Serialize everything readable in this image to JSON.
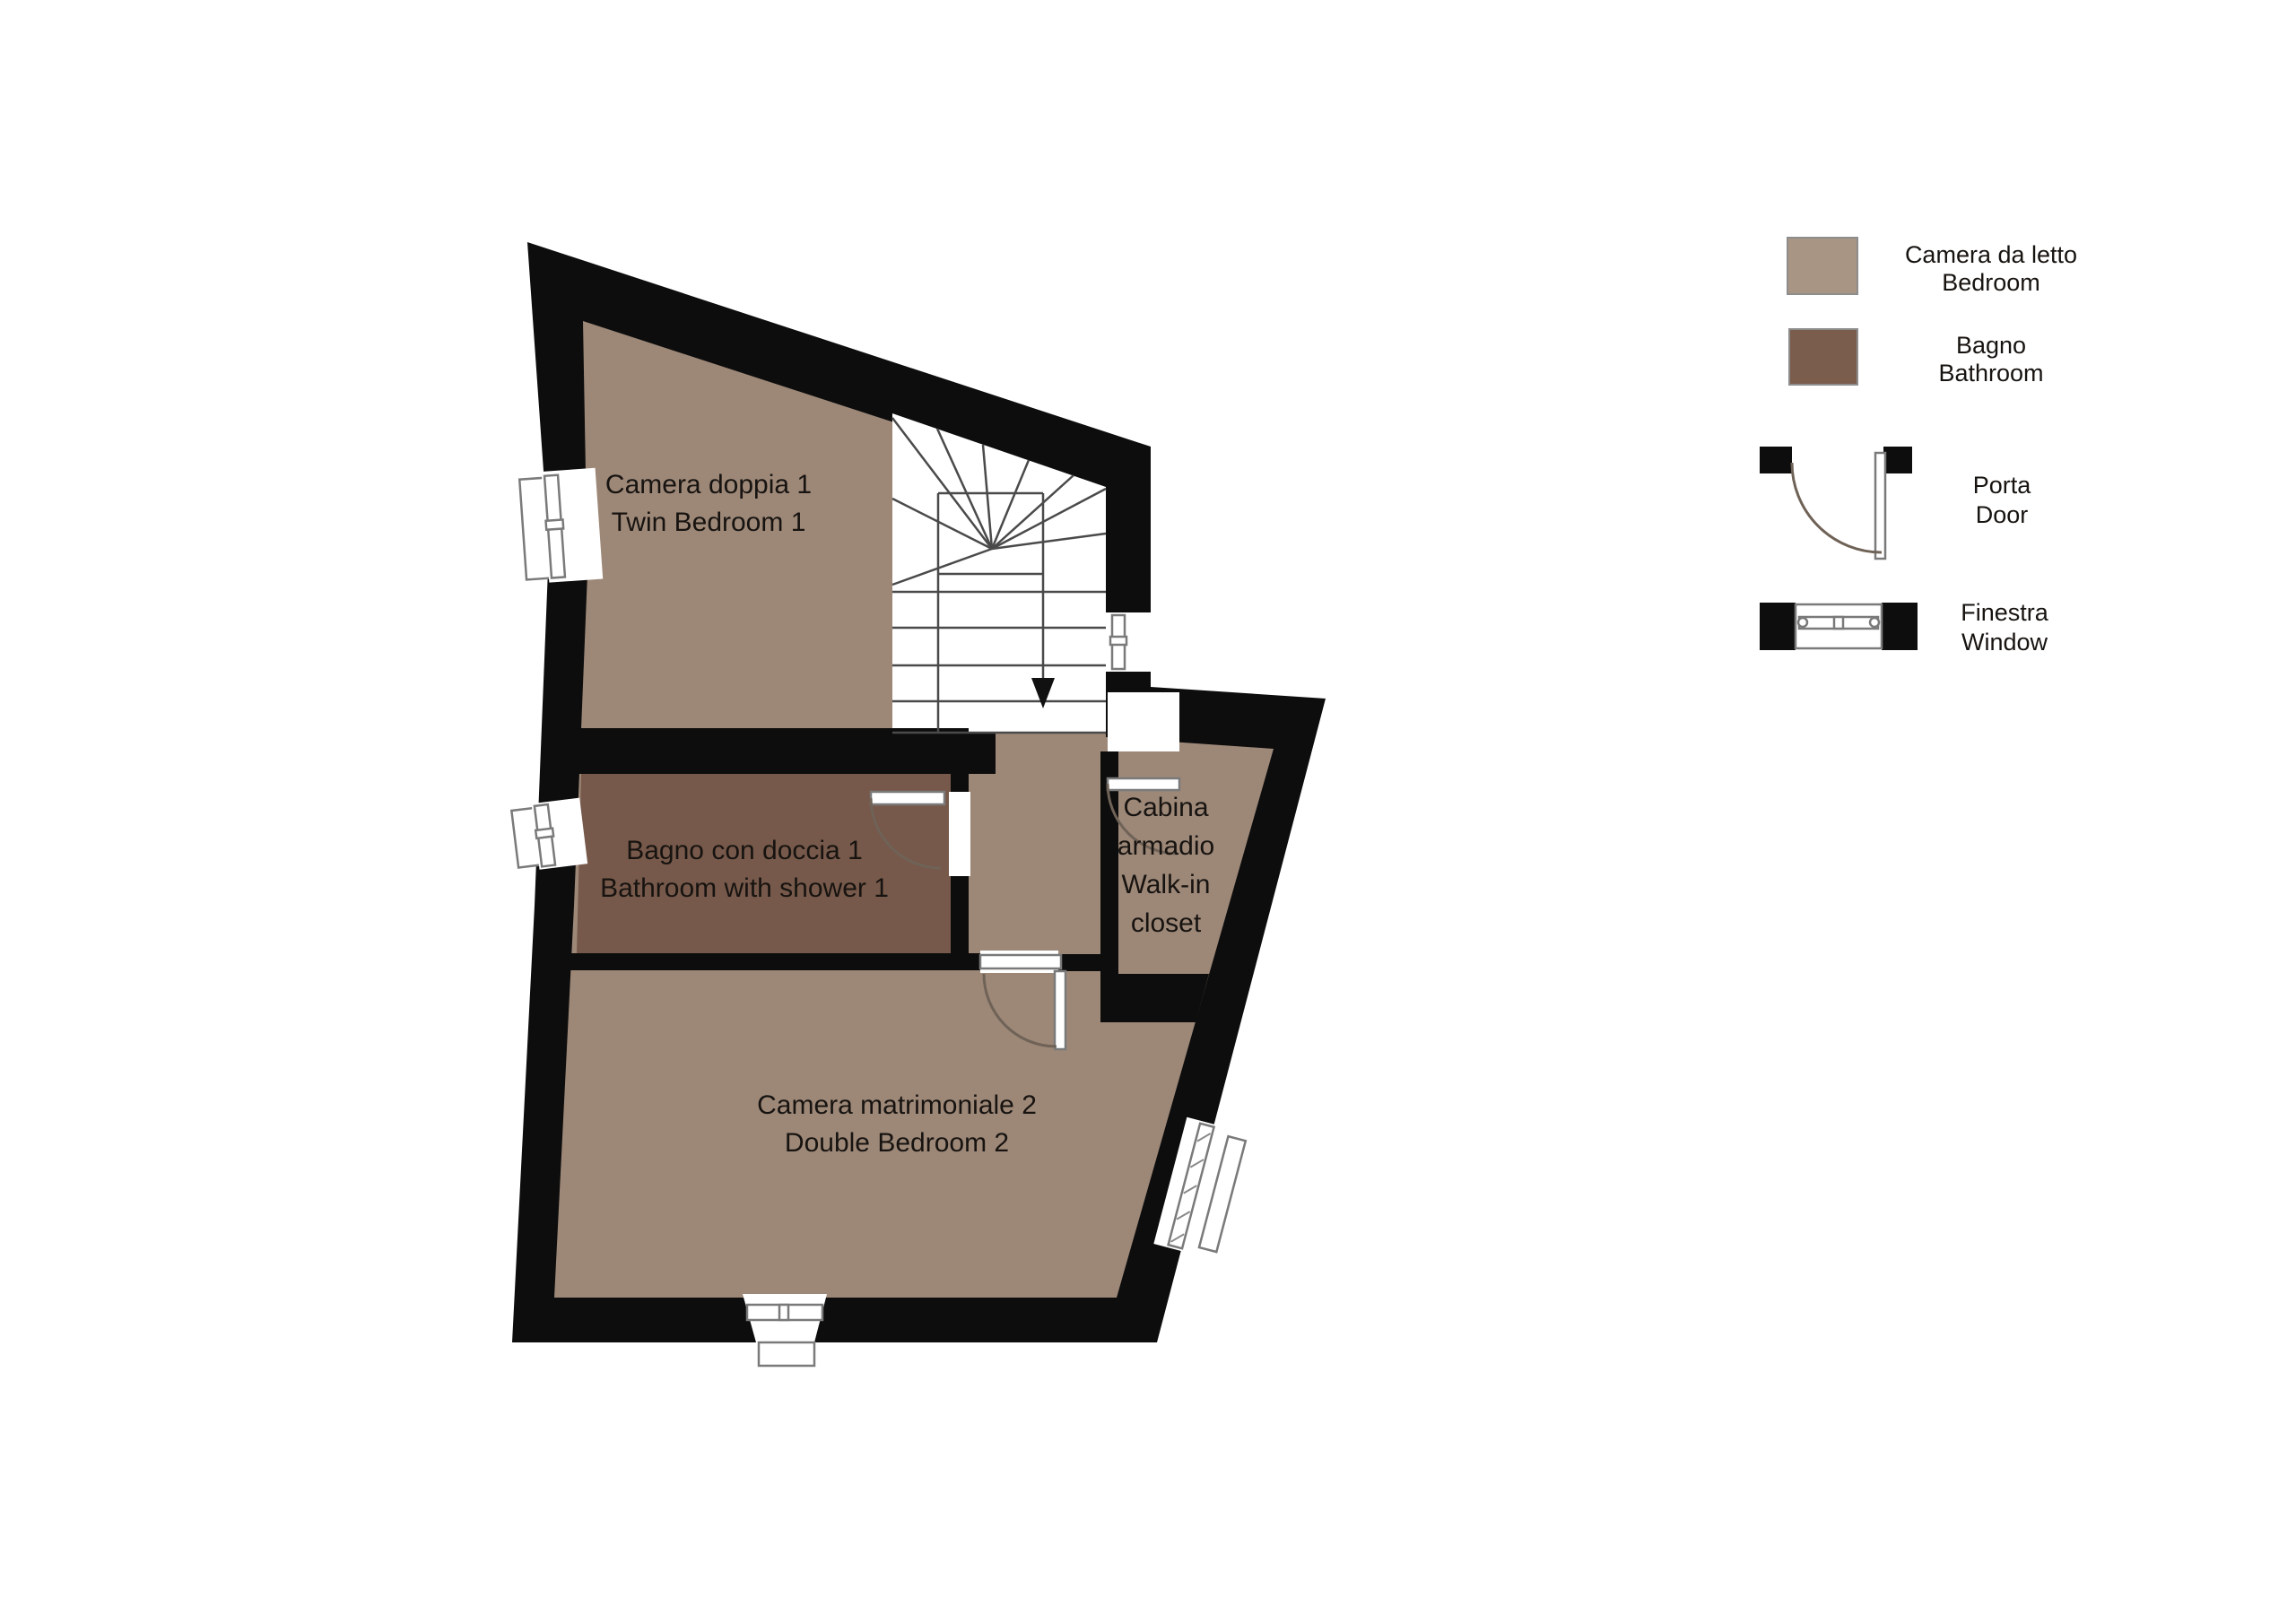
{
  "colors": {
    "bedroom_fill": "#9d8878",
    "bathroom_fill": "#76594a",
    "wall": "#0d0d0d",
    "legend_bedroom_swatch": "#a99584",
    "legend_bathroom_swatch": "#7b5d4e"
  },
  "rooms": {
    "twin_bedroom": {
      "line1": "Camera doppia 1",
      "line2": "Twin Bedroom 1"
    },
    "bathroom1": {
      "line1": "Bagno con doccia 1",
      "line2": "Bathroom with shower 1"
    },
    "walk_in_closet": {
      "line1": "Cabina",
      "line2": "armadio",
      "line3": "Walk-in",
      "line4": "closet"
    },
    "double_bedroom": {
      "line1": "Camera matrimoniale 2",
      "line2": "Double Bedroom 2"
    }
  },
  "legend": {
    "bedroom": {
      "label_it": "Camera da letto",
      "label_en": "Bedroom"
    },
    "bathroom": {
      "label_it": "Bagno",
      "label_en": "Bathroom"
    },
    "door": {
      "label_it": "Porta",
      "label_en": "Door"
    },
    "window": {
      "label_it": "Finestra",
      "label_en": "Window"
    }
  }
}
